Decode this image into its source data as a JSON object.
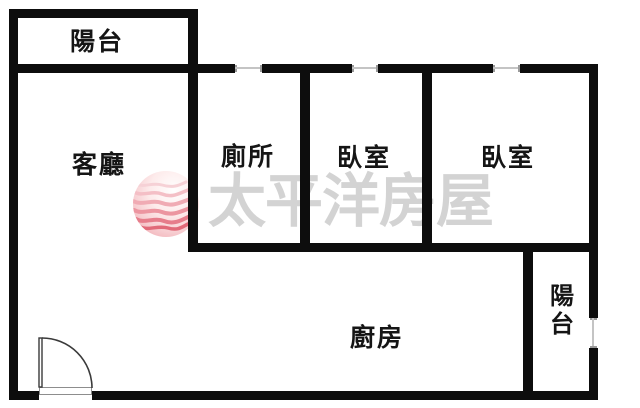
{
  "title": "apartment-floor-plan",
  "colors": {
    "wall": "#0d0d0d",
    "background": "#ffffff",
    "watermark_text": "#d3d3d3",
    "logo_pink_light": "#f6cdd2",
    "logo_red_deep": "#de5a6b",
    "window_line": "#c4c4c4",
    "door_line": "#3a3a3a"
  },
  "rooms": [
    {
      "id": "balcony-top",
      "label": "陽台"
    },
    {
      "id": "living-room",
      "label": "客廳"
    },
    {
      "id": "toilet",
      "label": "廁所"
    },
    {
      "id": "bedroom-left",
      "label": "臥室"
    },
    {
      "id": "bedroom-right",
      "label": "臥室"
    },
    {
      "id": "kitchen",
      "label": "廚房"
    },
    {
      "id": "balcony-right",
      "label": "陽台"
    }
  ],
  "watermark": {
    "brand_text": "太平洋房屋",
    "logo": "pacific-waves-logo"
  }
}
